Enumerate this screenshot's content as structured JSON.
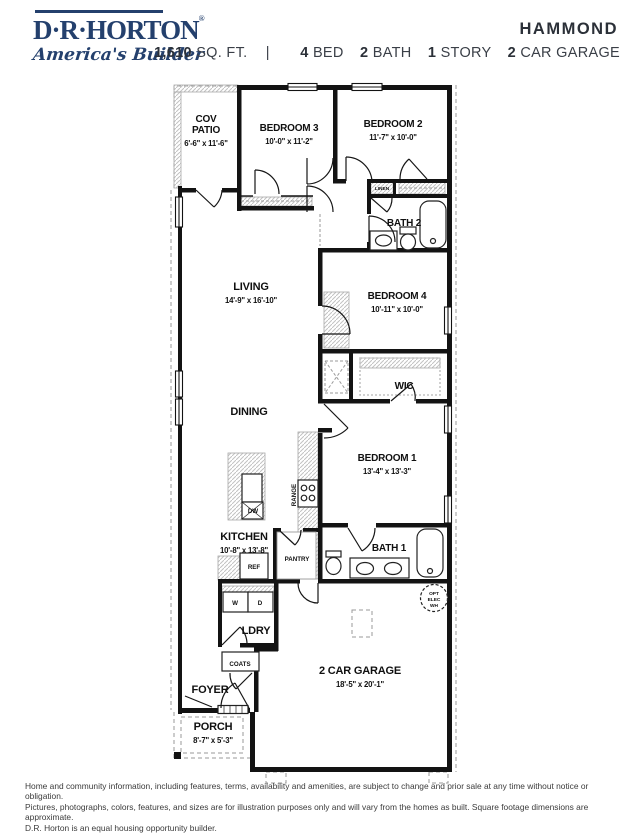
{
  "header": {
    "brand": "D·R·HORTON",
    "registered": "®",
    "tagline": "America's Builder",
    "plan_name": "HAMMOND",
    "specs": {
      "sqft": "1,610",
      "sqft_unit": "SQ. FT.",
      "separator": "|",
      "features": [
        {
          "value": "4",
          "label": "BED"
        },
        {
          "value": "2",
          "label": "BATH"
        },
        {
          "value": "1",
          "label": "STORY"
        },
        {
          "value": "2",
          "label": "CAR GARAGE"
        }
      ]
    }
  },
  "floorplan": {
    "rooms": {
      "cov_patio": {
        "line1": "COV",
        "line2": "PATIO",
        "dims": "6'-6\" x 11'-6\""
      },
      "bedroom3": {
        "name": "BEDROOM 3",
        "dims": "10'-0\" x 11'-2\""
      },
      "bedroom2": {
        "name": "BEDROOM 2",
        "dims": "11'-7\" x 10'-0\""
      },
      "living": {
        "name": "LIVING",
        "dims": "14'-9\" x 16'-10\""
      },
      "bedroom4": {
        "name": "BEDROOM 4",
        "dims": "10'-11\" x 10'-0\""
      },
      "dining": {
        "name": "DINING"
      },
      "wic": {
        "name": "WIC"
      },
      "bedroom1": {
        "name": "BEDROOM 1",
        "dims": "13'-4\" x 13'-3\""
      },
      "kitchen": {
        "name": "KITCHEN",
        "dims": "10'-8\" x 13'-8\""
      },
      "bath1": {
        "name": "BATH 1"
      },
      "bath2": {
        "name": "BATH 2"
      },
      "ldry": {
        "name": "LDRY"
      },
      "foyer": {
        "name": "FOYER"
      },
      "porch": {
        "name": "PORCH",
        "dims": "8'-7\" x 5'-3\""
      },
      "garage": {
        "name": "2 CAR GARAGE",
        "dims": "18'-5\" x 20'-1\""
      }
    },
    "fixtures": {
      "linen": "LINEN",
      "pantry": "PANTRY",
      "ref": "REF",
      "dw": "DW",
      "range": "RANGE",
      "washer": "W",
      "dryer": "D",
      "coats": "COATS",
      "opt_wh": {
        "line1": "OPT",
        "line2": "ELEC",
        "line3": "WH"
      }
    }
  },
  "footer": {
    "line1": "Home and community information, including features, terms, availability and amenities, are subject to change and prior sale at any time without notice or obligation.",
    "line2": "Pictures, photographs, colors, features, and sizes are for illustration purposes only and will vary from the homes as built. Square footage dimensions are approximate.",
    "line3": "D.R. Horton is an equal housing opportunity builder."
  }
}
